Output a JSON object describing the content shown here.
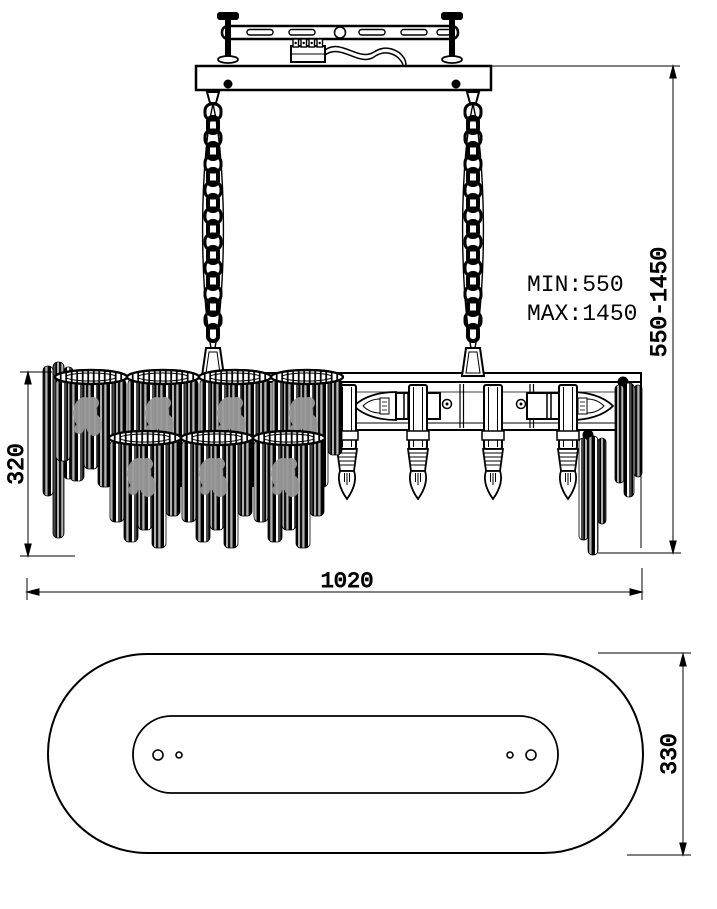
{
  "front_view": {
    "min_label": "MIN:550",
    "max_label": "MAX:1450",
    "suspension_range_label": "550-1450",
    "body_height_label": "320",
    "width_label": "1020"
  },
  "top_view": {
    "depth_label": "330"
  },
  "colors": {
    "line": "#000000",
    "crystal_gray": "#999999",
    "background": "#ffffff"
  }
}
